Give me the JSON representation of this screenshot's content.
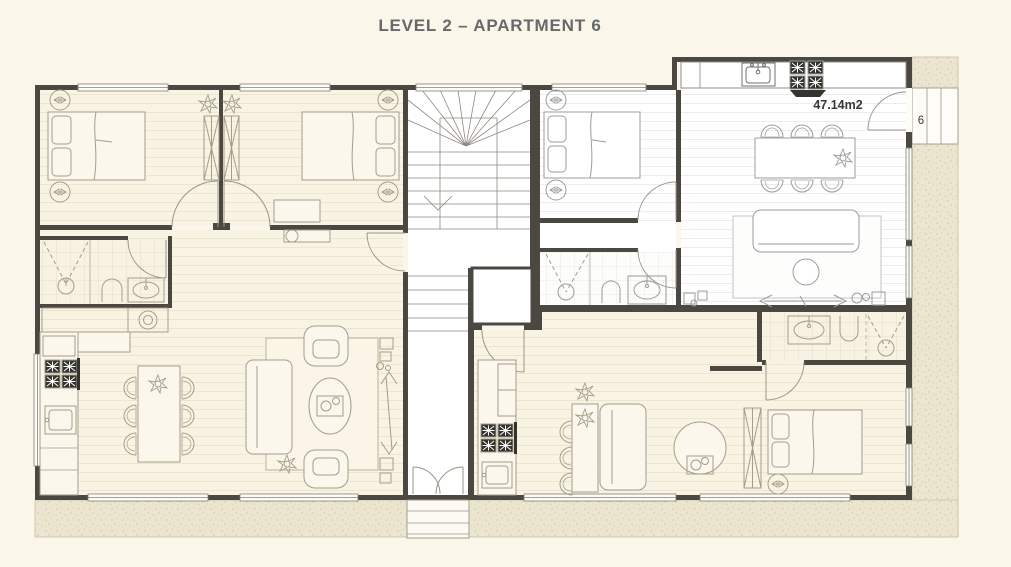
{
  "title": "LEVEL 2 – APARTMENT 6",
  "plan": {
    "area_label": "47.14m2",
    "unit_label": "6"
  },
  "colors": {
    "page_background": "#FAF6E9",
    "floor_cream": "#F8F3E2",
    "floor_white": "#FFFFFF",
    "wall": "#4B4741",
    "exterior_texture": "#ECE5CF",
    "furniture_line_cream": "#A49D8B",
    "furniture_line_white": "#9C9C9C",
    "stove_black": "#35332E",
    "title_text": "#67686B",
    "label_text": "#383838"
  }
}
